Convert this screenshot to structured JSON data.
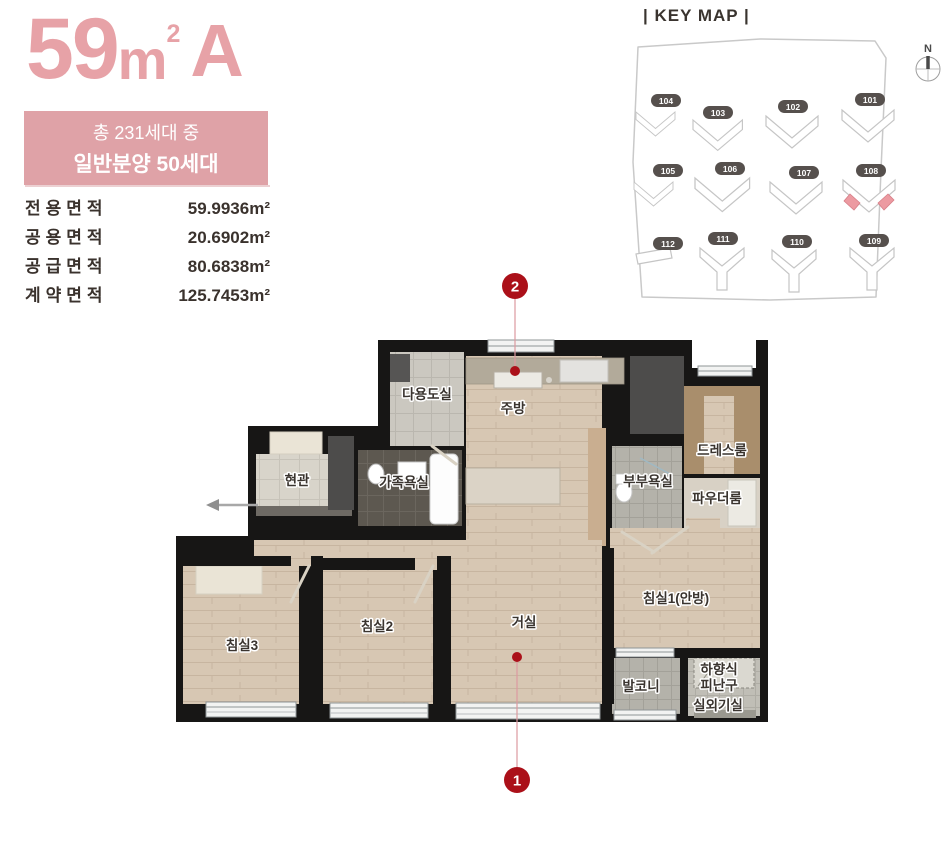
{
  "unit_info": {
    "title": {
      "number": "59",
      "unit": "m",
      "sup": "2",
      "type": "A"
    },
    "badge": {
      "line1": "총 231세대 중",
      "line2": "일반분양 50세대"
    },
    "areas": {
      "rows": [
        {
          "label": "전용면적",
          "value": "59.9936m²"
        },
        {
          "label": "공용면적",
          "value": "20.6902m²"
        },
        {
          "label": "공급면적",
          "value": "80.6838m²"
        },
        {
          "label": "계약면적",
          "value": "125.7453m²"
        }
      ]
    },
    "accent_color": "#e7a2a7",
    "badge_bg_color": "#dfa2a7"
  },
  "keymap": {
    "title": "| KEY MAP |",
    "compass_label": "N",
    "buildings": [
      "104",
      "103",
      "102",
      "101",
      "105",
      "106",
      "107",
      "108",
      "112",
      "111",
      "110",
      "109"
    ],
    "highlighted_building": "108",
    "highlight_color": "#ec9aa1"
  },
  "floorplan": {
    "rooms": {
      "utility": "다용도실",
      "kitchen": "주방",
      "dress": "드레스룸",
      "master_bath": "부부욕실",
      "powder": "파우더룸",
      "entrance": "현관",
      "family_bath": "가족욕실",
      "bed3": "침실3",
      "bed2": "침실2",
      "living": "거실",
      "bed1": "침실1(안방)",
      "balcony": "발코니",
      "escape_line1": "하향식",
      "escape_line2": "피난구",
      "ac_room": "실외기실"
    },
    "markers": [
      {
        "id": "1"
      },
      {
        "id": "2"
      }
    ],
    "marker_color": "#ab1019",
    "wall_color": "#171615"
  }
}
